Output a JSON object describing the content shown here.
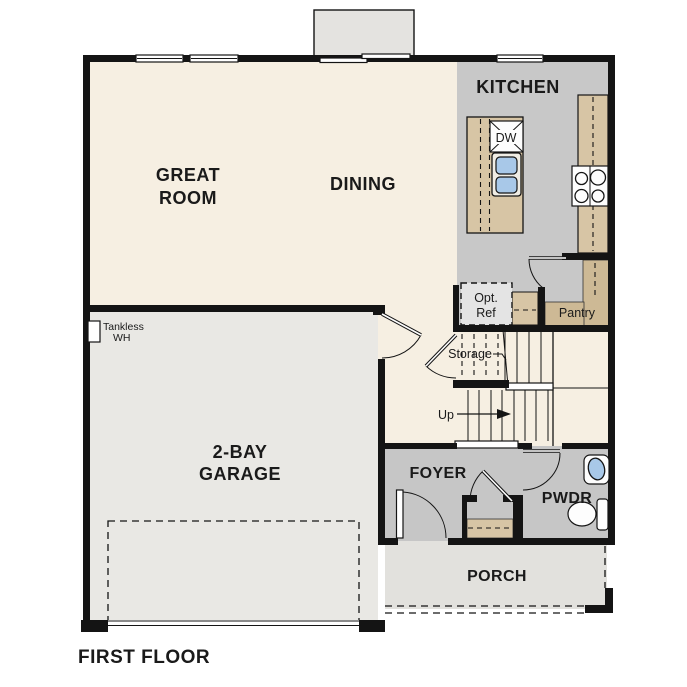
{
  "title": "FIRST FLOOR",
  "colors": {
    "wall": "#141414",
    "floor_cream": "#f6efe2",
    "kitchen_gray": "#c8c8c8",
    "foyer_gray": "#c6c6c6",
    "garage_gray": "#e9e8e4",
    "porch_gray": "#e2e1dd",
    "patio_gray": "#e4e3e0",
    "counter_tan": "#d7c5a5",
    "pantry_tan": "#cdb995",
    "ref_gray": "#e4e4e4",
    "sink_blue": "#a8c8e8"
  },
  "rooms": {
    "great_room": {
      "line1": "GREAT",
      "line2": "ROOM"
    },
    "dining": {
      "label": "DINING"
    },
    "kitchen": {
      "label": "KITCHEN"
    },
    "garage": {
      "line1": "2-BAY",
      "line2": "GARAGE"
    },
    "foyer": {
      "label": "FOYER"
    },
    "powder_room": {
      "label": "PWDR"
    },
    "porch": {
      "label": "PORCH"
    },
    "pantry": {
      "label": "Pantry"
    },
    "storage": {
      "label": "Storage"
    }
  },
  "annotations": {
    "stairs_direction": "Up",
    "optional_refrigerator": {
      "line1": "Opt.",
      "line2": "Ref"
    },
    "water_heater": {
      "line1": "Tankless",
      "line2": "WH"
    },
    "dishwasher": "DW"
  }
}
